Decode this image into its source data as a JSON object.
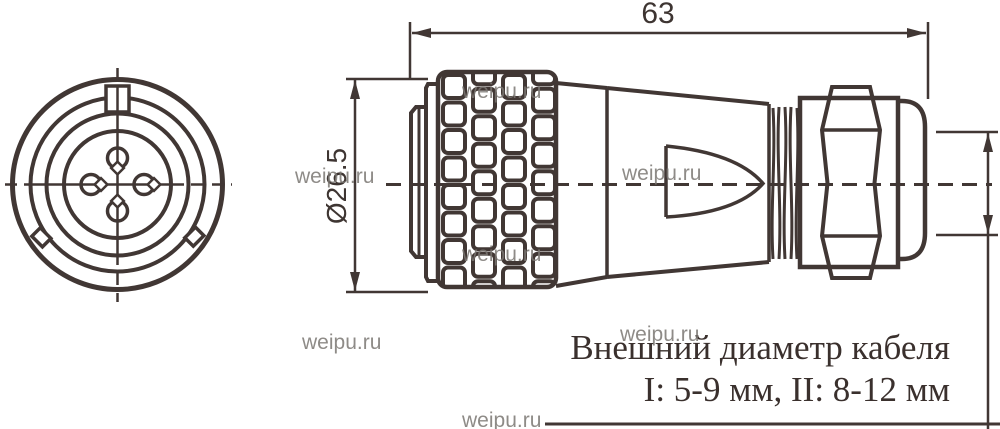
{
  "drawing": {
    "type": "technical-connector-drawing",
    "dimensions": {
      "length_label": "63",
      "diameter_label": "Ø26.5"
    },
    "note": {
      "line1": "Внешний диаметр кабеля",
      "line2": "I: 5-9 мм, II: 8-12 мм"
    },
    "watermark": "weipu.ru",
    "colors": {
      "line": "#413734",
      "text": "#3a302d",
      "watermark": "#7b7773",
      "background": "#ffffff"
    }
  }
}
